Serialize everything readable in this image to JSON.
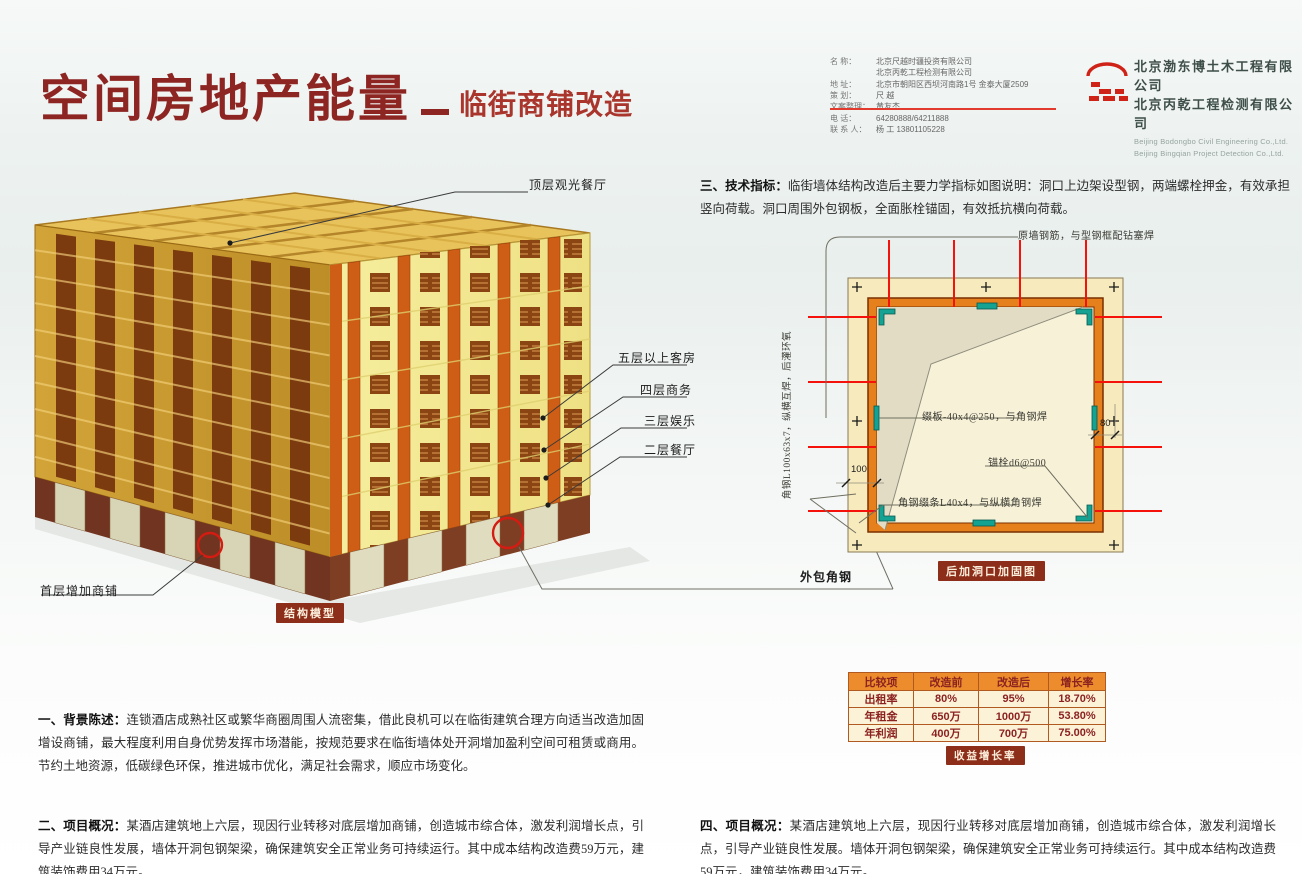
{
  "header": {
    "title": "空间房地产能量",
    "subtitle": "临街商铺改造",
    "info_rows": [
      {
        "label": "名    称：",
        "value": "北京尺越时疆投资有限公司"
      },
      {
        "label": "",
        "value": "北京丙乾工程检测有限公司"
      },
      {
        "label": "地    址：",
        "value": "北京市朝阳区西坝河南路1号 金泰大厦2509"
      },
      {
        "label": "策    划：",
        "value": "尺 越"
      },
      {
        "label": "文案整理：",
        "value": "黄友杰"
      },
      {
        "label": "电    话：",
        "value": "64280888/64211888"
      },
      {
        "label": "联 系 人：",
        "value": "杨 工 13801105228"
      }
    ],
    "companies": {
      "cn1": "北京渤东博土木工程有限公司",
      "cn2": "北京丙乾工程检测有限公司",
      "en1": "Beijing Bodongbo Civil Engineering Co.,Ltd.",
      "en2": "Beijing Bingqian Project Detection Co.,Ltd."
    }
  },
  "model": {
    "label_top": "顶层观光餐厅",
    "label_floor5": "五层以上客房",
    "label_floor4": "四层商务",
    "label_floor3": "三层娱乐",
    "label_floor2": "二层餐厅",
    "label_ground": "首层增加商铺",
    "caption": "结构模型"
  },
  "tech": {
    "heading": "三、技术指标：",
    "body": "临街墙体结构改造后主要力学指标如图说明：洞口上边架设型钢，两端螺栓押金，有效承担竖向荷载。洞口周围外包钢板，全面胀栓锚固，有效抵抗横向荷载。",
    "diagram": {
      "ann_top": "原墙钢筋，与型钢框配钻塞焊",
      "ann_left_vertical": "角钢L100x63x7，纵横互焊，后灌环氧",
      "ann_batten": "缀板-40x4@250，与角钢焊",
      "ann_anchor": "锚栓d6@500",
      "ann_lacing": "角钢缀条L40x4，与纵横角钢焊",
      "dim_100": "100",
      "dim_80": "80",
      "caption": "后加洞口加固图",
      "ann_outer": "外包角钢"
    }
  },
  "table": {
    "headers": [
      "比较项",
      "改造前",
      "改造后",
      "增长率"
    ],
    "rows": [
      [
        "出租率",
        "80%",
        "95%",
        "18.70%"
      ],
      [
        "年租金",
        "650万",
        "1000万",
        "53.80%"
      ],
      [
        "年利润",
        "400万",
        "700万",
        "75.00%"
      ]
    ],
    "caption": "收益增长率"
  },
  "sections": {
    "s1_heading": "一、背景陈述：",
    "s1_body": "连锁酒店成熟社区或繁华商圈周围人流密集，借此良机可以在临街建筑合理方向适当改造加固增设商铺，最大程度利用自身优势发挥市场潜能，按规范要求在临街墙体处开洞增加盈利空间可租赁或商用。节约土地资源，低碳绿色环保，推进城市优化，满足社会需求，顺应市场变化。",
    "s2_heading": "二、项目概况：",
    "s2_body": "某酒店建筑地上六层，现因行业转移对底层增加商铺，创造城市综合体，激发利润增长点，引导产业链良性发展，墙体开洞包钢架梁，确保建筑安全正常业务可持续运行。其中成本结构改造费59万元，建筑装饰费用34万元。",
    "s4_heading": "四、项目概况：",
    "s4_body": "某酒店建筑地上六层，现因行业转移对底层增加商铺，创造城市综合体，激发利润增长点，引导产业链良性发展。墙体开洞包钢架梁，确保建筑安全正常业务可持续运行。其中成本结构改造费59万元，建筑装饰费用34万元。"
  },
  "colors": {
    "accent_red": "#8d2523",
    "caption_bg": "#8c2e1a",
    "table_header_bg": "#ec8c2c",
    "steel_orange": "#e5801c",
    "batten_teal": "#14a392",
    "red_line": "#f5120b"
  }
}
